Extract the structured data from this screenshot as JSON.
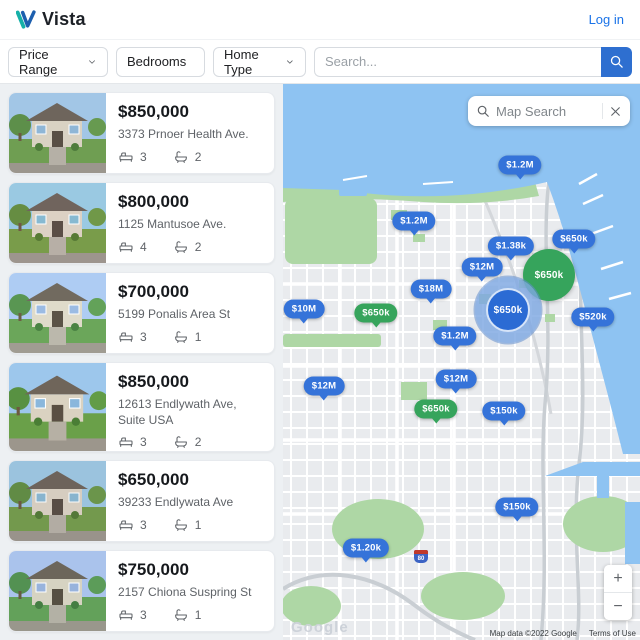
{
  "header": {
    "brand": "Vista",
    "login_label": "Log in"
  },
  "filters": {
    "price_range_label": "Price Range",
    "bedrooms_label": "Bedrooms",
    "home_type_label": "Home Type",
    "search_placeholder": "Search..."
  },
  "listings": [
    {
      "price": "$850,000",
      "address": "3373 Prnoer Health Ave.",
      "beds": "3",
      "baths": "2"
    },
    {
      "price": "$800,000",
      "address": "1125 Mantusoe Ave.",
      "beds": "4",
      "baths": "2"
    },
    {
      "price": "$700,000",
      "address": "5199 Ponalis Area St",
      "beds": "3",
      "baths": "1"
    },
    {
      "price": "$850,000",
      "address": "12613 Endlywath Ave, Suite USA",
      "beds": "3",
      "baths": "2"
    },
    {
      "price": "$650,000",
      "address": "39233 Endlywata Ave",
      "beds": "3",
      "baths": "1"
    },
    {
      "price": "$750,000",
      "address": "2157 Chiona Suspring St",
      "beds": "3",
      "baths": "1"
    }
  ],
  "map": {
    "search_placeholder": "Map Search",
    "zoom_in_label": "+",
    "zoom_out_label": "−",
    "highway_shield": "80",
    "watermark": "Google",
    "attribution": "Map data ©2022 Google",
    "terms_label": "Terms of Use",
    "marker_colors": {
      "blue": "#3573d9",
      "green": "#36a45c"
    },
    "markers": [
      {
        "label": "$1.2M",
        "color": "blue",
        "variant": "bubble",
        "x": 237,
        "y": 81
      },
      {
        "label": "$1.2M",
        "color": "blue",
        "variant": "bubble",
        "x": 131,
        "y": 137
      },
      {
        "label": "$650k",
        "color": "blue",
        "variant": "bubble",
        "x": 291,
        "y": 155
      },
      {
        "label": "$1.38k",
        "color": "blue",
        "variant": "bubble",
        "x": 228,
        "y": 162
      },
      {
        "label": "$12M",
        "color": "blue",
        "variant": "bubble",
        "x": 199,
        "y": 183
      },
      {
        "label": "$650k",
        "color": "green",
        "variant": "circle-large",
        "x": 266,
        "y": 191
      },
      {
        "label": "$18M",
        "color": "blue",
        "variant": "bubble",
        "x": 148,
        "y": 205
      },
      {
        "label": "$10M",
        "color": "blue",
        "variant": "bubble",
        "x": 21,
        "y": 225
      },
      {
        "label": "$650k",
        "color": "green",
        "variant": "bubble",
        "x": 93,
        "y": 229
      },
      {
        "label": "$650k",
        "color": "blue",
        "variant": "circle-selected",
        "x": 225,
        "y": 226
      },
      {
        "label": "$520k",
        "color": "blue",
        "variant": "bubble",
        "x": 310,
        "y": 233
      },
      {
        "label": "$1.2M",
        "color": "blue",
        "variant": "bubble",
        "x": 172,
        "y": 252
      },
      {
        "label": "$12M",
        "color": "blue",
        "variant": "bubble",
        "x": 173,
        "y": 295
      },
      {
        "label": "$12M",
        "color": "blue",
        "variant": "bubble",
        "x": 41,
        "y": 302
      },
      {
        "label": "$650k",
        "color": "green",
        "variant": "bubble",
        "x": 153,
        "y": 325
      },
      {
        "label": "$150k",
        "color": "blue",
        "variant": "bubble",
        "x": 221,
        "y": 327
      },
      {
        "label": "$150k",
        "color": "blue",
        "variant": "bubble",
        "x": 234,
        "y": 423
      },
      {
        "label": "$1.20k",
        "color": "blue",
        "variant": "bubble",
        "x": 83,
        "y": 464
      }
    ]
  }
}
